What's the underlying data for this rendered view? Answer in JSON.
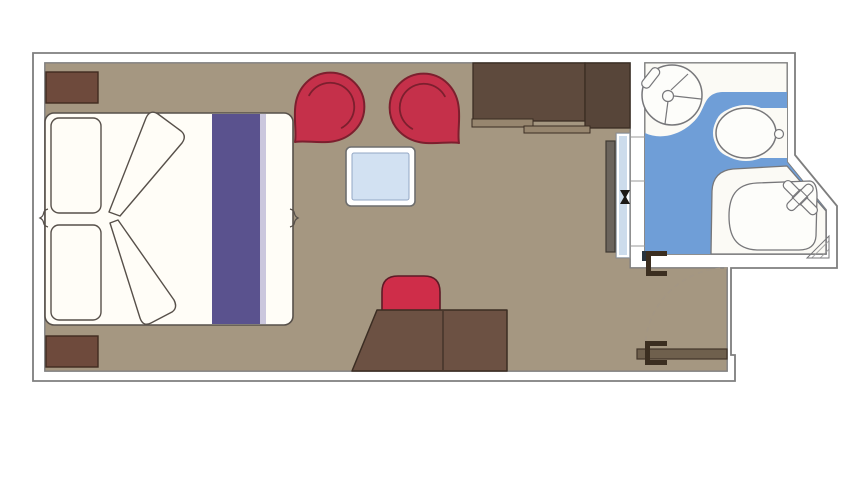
{
  "floorplan": {
    "kind": "cabin-floorplan",
    "rooms": [
      {
        "name": "bedroom"
      },
      {
        "name": "bathroom"
      },
      {
        "name": "entry-vestibule"
      }
    ],
    "furniture": [
      {
        "name": "double-bed"
      },
      {
        "name": "pillow-left"
      },
      {
        "name": "pillow-right"
      },
      {
        "name": "bed-runner"
      },
      {
        "name": "folded-duvet"
      },
      {
        "name": "nightstand-top"
      },
      {
        "name": "nightstand-bottom"
      },
      {
        "name": "armchair-left"
      },
      {
        "name": "armchair-right"
      },
      {
        "name": "coffee-table"
      },
      {
        "name": "wardrobe"
      },
      {
        "name": "mirror-closet-unit"
      },
      {
        "name": "desk"
      },
      {
        "name": "desk-chair"
      },
      {
        "name": "entry-door"
      },
      {
        "name": "washbasin"
      },
      {
        "name": "toilet"
      },
      {
        "name": "shower"
      }
    ]
  },
  "colors": {
    "page_bg": "#ffffff",
    "wall_fill": "#ffffff",
    "wall_stroke": "#7e7e7e",
    "seam_gray": "#9a9a9a",
    "floor_tan": "#a59781",
    "bath_white": "#fbfaf5",
    "bath_blue": "#6f9ed7",
    "fixture_white": "#fdfdfa",
    "fixture_stroke": "#77777a",
    "bed_white": "#fffdf7",
    "bed_stroke": "#57504a",
    "runner_purple": "#5a528e",
    "runner_purple_light": "#b9b4d4",
    "nightstand_brown": "#6e4a3c",
    "nightstand_stroke": "#402b20",
    "wardrobe_brown": "#5e4a3d",
    "wardrobe_brown_dark": "#574539",
    "wardrobe_rail": "#97866f",
    "furniture_dark_stroke": "#3b2d23",
    "desk_brown": "#6c5143",
    "door_brown": "#6f604d",
    "door_stroke": "#42362a",
    "chair_red": "#c5304a",
    "chair_red_dark": "#7c1f2e",
    "desk_chair_red": "#cf2d49",
    "desk_chair_stroke": "#5d1a26",
    "table_frame": "#ffffff",
    "table_frame_stroke": "#6e6e6e",
    "table_blue": "#d2e1f2",
    "table_blue_stroke": "#93a7c4",
    "panel_blue": "#ccdcec",
    "panel_stroke": "#8a8a8a",
    "slab_gray": "#6b645c",
    "slab_stroke": "#3f3a33",
    "knob_black": "#1c1a17",
    "hinge_dark": "#3b2e20",
    "navy": "#28343f",
    "arc_dash": "#a39684",
    "hatch_gray": "#9a9a9a"
  }
}
